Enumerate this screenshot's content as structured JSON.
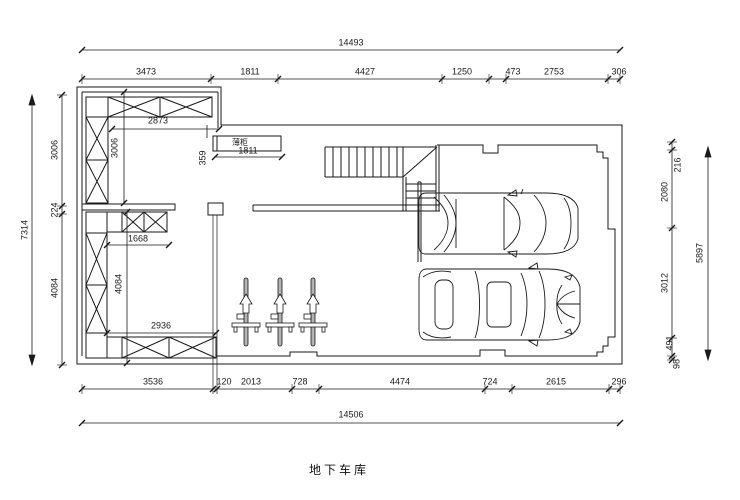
{
  "title": "地下车库",
  "plan": {
    "thin_cabinet_label": "薄柜"
  },
  "dims": {
    "top_overall": "14493",
    "top": [
      "3473",
      "1811",
      "4427",
      "1250",
      "473",
      "2753",
      "306"
    ],
    "bottom": [
      "3536",
      "120",
      "2013",
      "728",
      "4474",
      "724",
      "2615",
      "296"
    ],
    "bottom_overall": "14506",
    "left_overall": "7314",
    "left": [
      "3006",
      "224",
      "4084"
    ],
    "right": [
      "216",
      "2080",
      "3012",
      "491",
      "98"
    ],
    "right_overall": "5897",
    "interior": {
      "upper_cabinet_width": "2873",
      "upper_left_depth": "3006",
      "thin_cabinet_width": "1811",
      "thin_cabinet_gap": "359",
      "mid_cabinet_width": "1668",
      "lower_left_height": "4084",
      "bottom_cabinet_width": "2936"
    }
  }
}
